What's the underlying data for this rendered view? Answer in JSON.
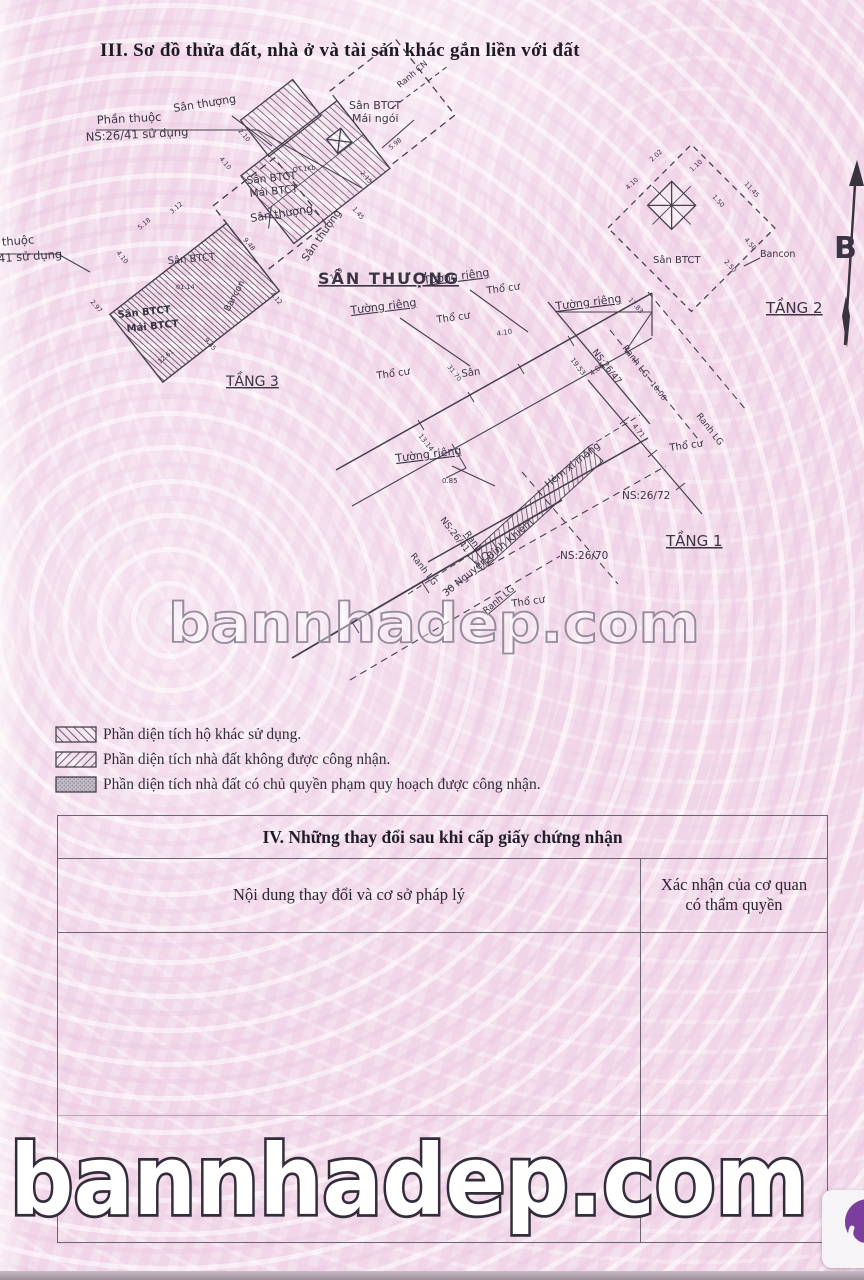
{
  "page": {
    "section3_title": "III. Sơ đồ thửa đất, nhà ở và tài sản khác gắn liền với đất",
    "watermark_mid": "bannhadep.com",
    "watermark_bottom": "bannhadep.com"
  },
  "legend": {
    "items": [
      {
        "pattern": "backslash-hatch",
        "label": "Phần diện tích hộ khác sử dụng."
      },
      {
        "pattern": "slash-hatch",
        "label": "Phần diện tích nhà đất không được công nhận."
      },
      {
        "pattern": "gray-fill",
        "label": "Phần diện tích nhà đất có chủ quyền phạm quy hoạch được công nhận."
      }
    ]
  },
  "section4": {
    "title": "IV. Những thay đổi sau khi cấp giấy chứng nhận",
    "col1": "Nội dung thay đổi và cơ sở pháp lý",
    "col2": "Xác nhận của cơ quan\ncó thẩm quyền"
  },
  "diagram": {
    "north_label": "B",
    "labels": [
      {
        "t": "Sân thượng",
        "x": 174,
        "y": 112,
        "r": -9,
        "s": 11
      },
      {
        "t": "Phần thuộc",
        "x": 97,
        "y": 124,
        "r": -3,
        "s": 11.5
      },
      {
        "t": "NS:26/41 sử dụng",
        "x": 86,
        "y": 141,
        "r": -3,
        "s": 11.5
      },
      {
        "t": "Sân BTCT",
        "x": 349,
        "y": 109,
        "s": 11
      },
      {
        "t": "Mái ngói",
        "x": 352,
        "y": 122,
        "s": 11
      },
      {
        "t": "Ranh CN",
        "x": 400,
        "y": 88,
        "r": -40,
        "s": 8.5
      },
      {
        "t": "Sân BTCT",
        "x": 247,
        "y": 184,
        "r": -6,
        "s": 10.5
      },
      {
        "t": "Mái BTCT",
        "x": 250,
        "y": 197,
        "r": -6,
        "s": 10.5
      },
      {
        "t": "Sân thượng",
        "x": 307,
        "y": 262,
        "r": -55,
        "s": 10.5
      },
      {
        "t": "Sân thượng",
        "x": 251,
        "y": 222,
        "r": -9,
        "s": 11
      },
      {
        "t": "OT.1Kb",
        "x": 293,
        "y": 172,
        "r": -6,
        "s": 6.5
      },
      {
        "t": "5.98",
        "x": 391,
        "y": 150,
        "r": -40,
        "s": 6.5
      },
      {
        "t": "2.15",
        "x": 360,
        "y": 173,
        "r": 50,
        "s": 6.5
      },
      {
        "t": "1.45",
        "x": 352,
        "y": 209,
        "r": 50,
        "s": 6.5
      },
      {
        "t": "2.10",
        "x": 238,
        "y": 131,
        "r": 50,
        "s": 6.5
      },
      {
        "t": "4.10",
        "x": 219,
        "y": 159,
        "r": 50,
        "s": 6.5
      },
      {
        "t": "7.59",
        "x": 332,
        "y": 280,
        "r": -40,
        "s": 6.5
      },
      {
        "t": "Phần thuộc",
        "x": -30,
        "y": 248,
        "r": -4,
        "s": 11.5
      },
      {
        "t": "NS:26/41 sử dụng",
        "x": -40,
        "y": 265,
        "r": -4,
        "s": 11.5
      },
      {
        "t": "Sân BTCT",
        "x": 168,
        "y": 264,
        "r": -5,
        "s": 10
      },
      {
        "t": "01.14",
        "x": 176,
        "y": 289,
        "s": 6.5
      },
      {
        "t": "Sân BTCT",
        "x": 118,
        "y": 318,
        "r": -6,
        "s": 10,
        "w": 1
      },
      {
        "t": "Mái BTCT",
        "x": 127,
        "y": 332,
        "r": -6,
        "s": 10,
        "w": 1
      },
      {
        "t": "Bancon",
        "x": 229,
        "y": 312,
        "r": -62,
        "s": 9
      },
      {
        "t": "TẦNG 3",
        "x": 226,
        "y": 386,
        "s": 14,
        "u": 1
      },
      {
        "t": "4.10",
        "x": 116,
        "y": 253,
        "r": 50,
        "s": 6.5
      },
      {
        "t": "2.97",
        "x": 90,
        "y": 302,
        "r": 50,
        "s": 6.5
      },
      {
        "t": "12.61",
        "x": 160,
        "y": 364,
        "r": -40,
        "s": 6.5
      },
      {
        "t": "9.45",
        "x": 204,
        "y": 340,
        "r": 50,
        "s": 6.5
      },
      {
        "t": "5.18",
        "x": 140,
        "y": 230,
        "r": -40,
        "s": 6.5
      },
      {
        "t": "3.12",
        "x": 172,
        "y": 214,
        "r": -40,
        "s": 6.5
      },
      {
        "t": "9.48",
        "x": 243,
        "y": 240,
        "r": 50,
        "s": 6.5
      },
      {
        "t": "4.12",
        "x": 270,
        "y": 294,
        "r": 50,
        "s": 6.5
      },
      {
        "t": "Sân BTCT",
        "x": 653,
        "y": 263,
        "s": 10
      },
      {
        "t": "Bancon",
        "x": 760,
        "y": 257,
        "s": 9.5
      },
      {
        "t": "TẦNG 2",
        "x": 766,
        "y": 313,
        "s": 15,
        "u": 1
      },
      {
        "t": "11.45",
        "x": 744,
        "y": 184,
        "r": 48,
        "s": 6.5
      },
      {
        "t": "1.10",
        "x": 692,
        "y": 172,
        "r": -42,
        "s": 6.5
      },
      {
        "t": "1.50",
        "x": 712,
        "y": 197,
        "r": 48,
        "s": 6.5
      },
      {
        "t": "2.50",
        "x": 724,
        "y": 262,
        "r": 48,
        "s": 6.5
      },
      {
        "t": "4.50",
        "x": 744,
        "y": 240,
        "r": 48,
        "s": 6.5
      },
      {
        "t": "2.02",
        "x": 652,
        "y": 162,
        "r": -42,
        "s": 6.5
      },
      {
        "t": "4.10",
        "x": 628,
        "y": 190,
        "r": -42,
        "s": 6.5
      },
      {
        "t": "17.83",
        "x": 628,
        "y": 300,
        "r": 48,
        "s": 6.5
      },
      {
        "t": "SÂN THƯỢNG",
        "x": 318,
        "y": 284,
        "s": 16,
        "u": 1,
        "ls": 2,
        "w": 1
      },
      {
        "t": "Tường riêng",
        "x": 424,
        "y": 284,
        "r": -7,
        "s": 11,
        "u": 1
      },
      {
        "t": "Tường riêng",
        "x": 351,
        "y": 314,
        "r": -7,
        "s": 11,
        "u": 1
      },
      {
        "t": "Tường riêng",
        "x": 556,
        "y": 310,
        "r": -7,
        "s": 11,
        "u": 1
      },
      {
        "t": "Tường riêng",
        "x": 396,
        "y": 462,
        "r": -7,
        "s": 11,
        "u": 1
      },
      {
        "t": "Thổ cư",
        "x": 487,
        "y": 294,
        "r": -8,
        "s": 10
      },
      {
        "t": "Thổ cư",
        "x": 437,
        "y": 323,
        "r": -8,
        "s": 10
      },
      {
        "t": "Thổ cư",
        "x": 377,
        "y": 379,
        "r": -8,
        "s": 10
      },
      {
        "t": "Thổ cư",
        "x": 670,
        "y": 451,
        "r": -8,
        "s": 10
      },
      {
        "t": "Thổ cư",
        "x": 512,
        "y": 607,
        "r": -8,
        "s": 10
      },
      {
        "t": "Sân",
        "x": 462,
        "y": 377,
        "r": -8,
        "s": 10
      },
      {
        "t": "4.10",
        "x": 497,
        "y": 336,
        "r": -9,
        "s": 7
      },
      {
        "t": "19.53",
        "x": 570,
        "y": 360,
        "r": 52,
        "s": 7
      },
      {
        "t": "NS:26/47",
        "x": 592,
        "y": 352,
        "r": 52,
        "s": 9
      },
      {
        "t": "Ranh LG",
        "x": 622,
        "y": 348,
        "r": 52,
        "s": 9
      },
      {
        "t": "10.00",
        "x": 650,
        "y": 384,
        "r": 52,
        "s": 7.5
      },
      {
        "t": "Ranh LG",
        "x": 696,
        "y": 416,
        "r": 52,
        "s": 9
      },
      {
        "t": "NS:26/72",
        "x": 622,
        "y": 499,
        "s": 10.5
      },
      {
        "t": "Hẻm xi măng",
        "x": 548,
        "y": 488,
        "r": -38,
        "s": 10
      },
      {
        "t": "NS:26/70",
        "x": 560,
        "y": 559,
        "s": 10.5
      },
      {
        "t": "TẦNG 1",
        "x": 666,
        "y": 546,
        "s": 15,
        "u": 1
      },
      {
        "t": "NS:26/41",
        "x": 440,
        "y": 520,
        "r": 52,
        "s": 9
      },
      {
        "t": "Ranh LG",
        "x": 410,
        "y": 556,
        "r": 52,
        "s": 9
      },
      {
        "t": "Ranh CN",
        "x": 464,
        "y": 534,
        "r": 52,
        "s": 9,
        "u": 1
      },
      {
        "t": "0.85",
        "x": 442,
        "y": 483,
        "s": 7
      },
      {
        "t": "13.14",
        "x": 418,
        "y": 436,
        "r": 52,
        "s": 7
      },
      {
        "t": "31.70",
        "x": 447,
        "y": 367,
        "r": 52,
        "s": 6.5
      },
      {
        "t": "4.71",
        "x": 632,
        "y": 426,
        "r": 52,
        "s": 7
      },
      {
        "t": "4.08",
        "x": 592,
        "y": 376,
        "r": -38,
        "s": 7
      },
      {
        "t": "30 Nguyễn Bỉnh Khiêm",
        "x": 446,
        "y": 597,
        "r": -40,
        "s": 10
      },
      {
        "t": "Ranh LG",
        "x": 486,
        "y": 614,
        "r": -40,
        "s": 9,
        "u": 1
      },
      {
        "t": "B",
        "x": 834,
        "y": 258,
        "s": 30,
        "w": 1
      }
    ]
  }
}
